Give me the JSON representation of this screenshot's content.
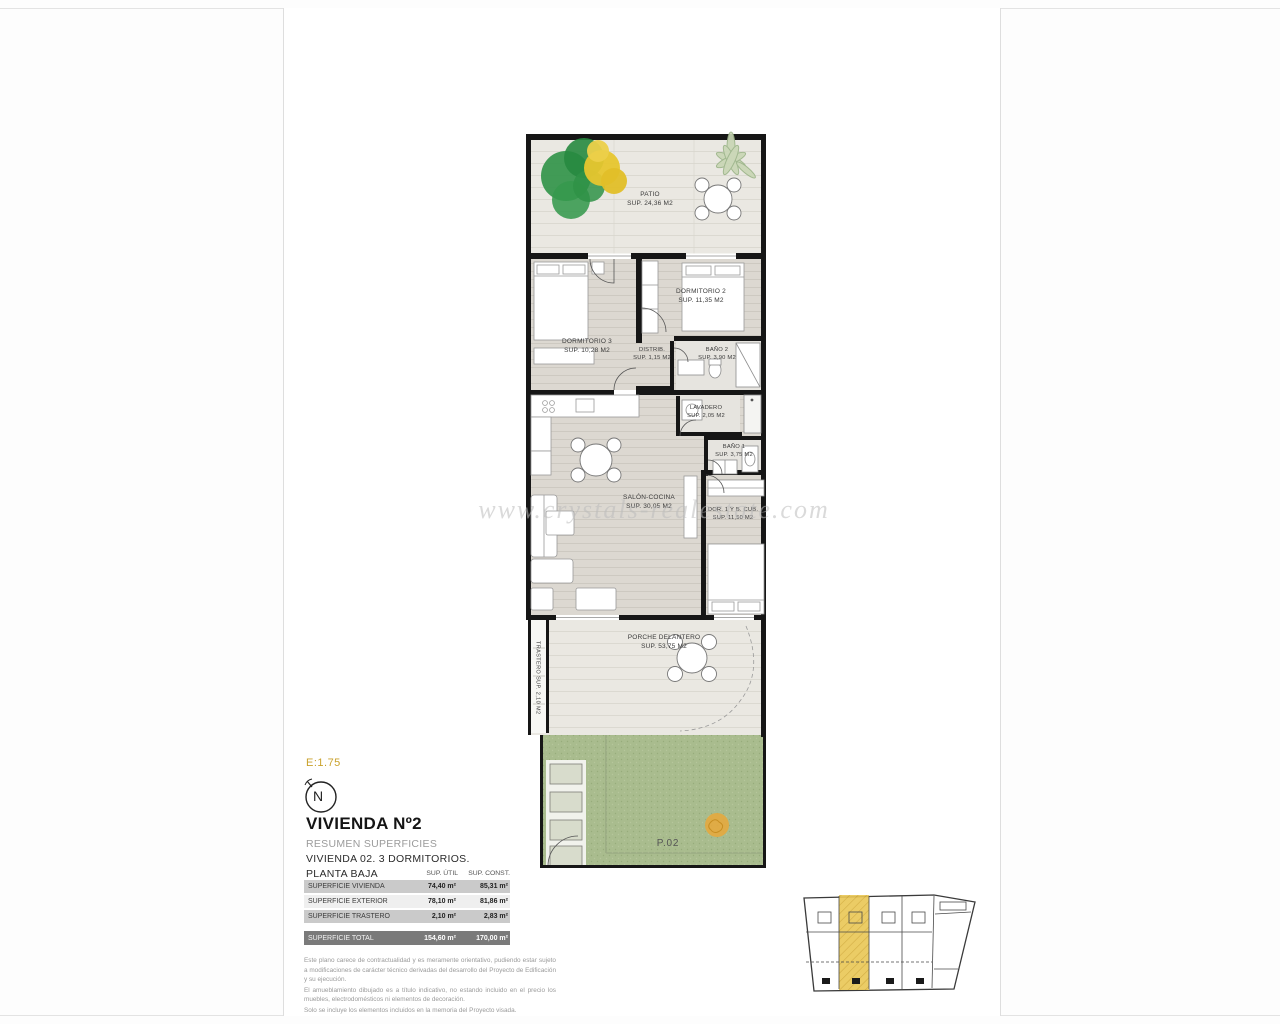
{
  "watermark": "www.crystals-realestate.com",
  "plan": {
    "rooms": [
      {
        "id": "patio",
        "name": "PATIO",
        "sup": "SUP. 24,36 M2"
      },
      {
        "id": "dormitorio-2",
        "name": "DORMITORIO 2",
        "sup": "SUP. 11,35 M2"
      },
      {
        "id": "dormitorio-3",
        "name": "DORMITORIO 3",
        "sup": "SUP. 10,28 M2"
      },
      {
        "id": "distribuidor",
        "name": "DISTRIB.",
        "sup": "SUP. 1,15 M2"
      },
      {
        "id": "bano-2",
        "name": "BAÑO 2",
        "sup": "SUP. 3,90 M2"
      },
      {
        "id": "lavadero",
        "name": "LAVADERO",
        "sup": "SUP. 2,05 M2"
      },
      {
        "id": "bano-1",
        "name": "BAÑO 1",
        "sup": "SUP. 3,75 M2"
      },
      {
        "id": "salon-cocina",
        "name": "SALÓN-COCINA",
        "sup": "SUP. 30,05 M2"
      },
      {
        "id": "dormitorio-1",
        "name": "DOR. 1 Y B. CUB.",
        "sup": "SUP. 11,50 M2"
      },
      {
        "id": "porche",
        "name": "PORCHE DELANTERO",
        "sup": "SUP. 53,75 M2"
      },
      {
        "id": "trastero",
        "name": "TRASTERO  SUP. 2,10 M2"
      }
    ],
    "parcel_label": "P.02"
  },
  "legend": {
    "scale": "E:1.75",
    "north": "N",
    "title": "VIVIENDA Nº2",
    "subtitle": "RESUMEN SUPERFICIES",
    "descriptor": "VIVIENDA 02. 3 DORMITORIOS.",
    "floor": "PLANTA BAJA"
  },
  "areas_table": {
    "col_headers": [
      "SUP. ÚTIL",
      "SUP. CONST."
    ],
    "rows": [
      {
        "label": "SUPERFICIE VIVIENDA",
        "util": "74,40 m²",
        "constr": "85,31 m²"
      },
      {
        "label": "SUPERFICIE EXTERIOR",
        "util": "78,10 m²",
        "constr": "81,86 m²"
      },
      {
        "label": "SUPERFICIE TRASTERO",
        "util": "2,10 m²",
        "constr": "2,83 m²"
      }
    ],
    "total": {
      "label": "SUPERFICIE TOTAL",
      "util": "154,60 m²",
      "constr": "170,00 m²"
    }
  },
  "disclaimer": {
    "p1": "Este plano carece de contractualidad y es meramente orientativo, pudiendo estar sujeto a modificaciones de carácter técnico derivadas del desarrollo del Proyecto de Edificación y su ejecución.",
    "p2": "El amueblamiento dibujado es a título indicativo, no estando incluido en el precio los muebles, electrodomésticos ni elementos de decoración.",
    "p3": "Solo se incluye los elementos incluidos en la memoria del Proyecto visada."
  },
  "colors": {
    "accent_gold": "#c9a22c",
    "highlight_yellow": "#e9c654",
    "garden_green": "#a9bc8e",
    "wall_black": "#161616",
    "total_row_gray": "#7a7a7a"
  }
}
